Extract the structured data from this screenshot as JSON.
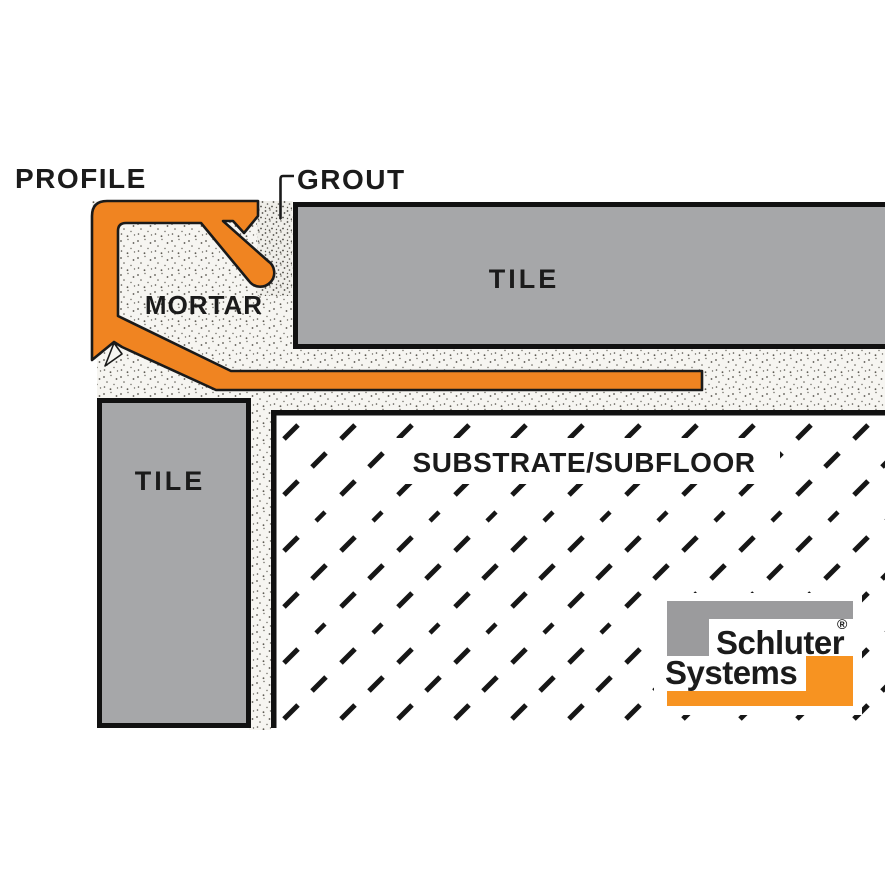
{
  "diagram": {
    "title": "Tile edge profile installation cross-section",
    "labels": {
      "profile": "PROFILE",
      "grout": "GROUT",
      "mortar": "MORTAR",
      "tile_top": "TILE",
      "tile_left": "TILE",
      "substrate": "SUBSTRATE/SUBFLOOR"
    },
    "logo": {
      "line1": "Schluter",
      "registered": "®",
      "line2": "Systems"
    },
    "colors": {
      "profile_orange": "#F08421",
      "logo_orange": "#F79321",
      "tile_gray": "#A6A7A9",
      "logo_gray": "#9B9B9D",
      "outline_black": "#1a1a1a",
      "mortar_base": "#F6F5F1"
    }
  }
}
